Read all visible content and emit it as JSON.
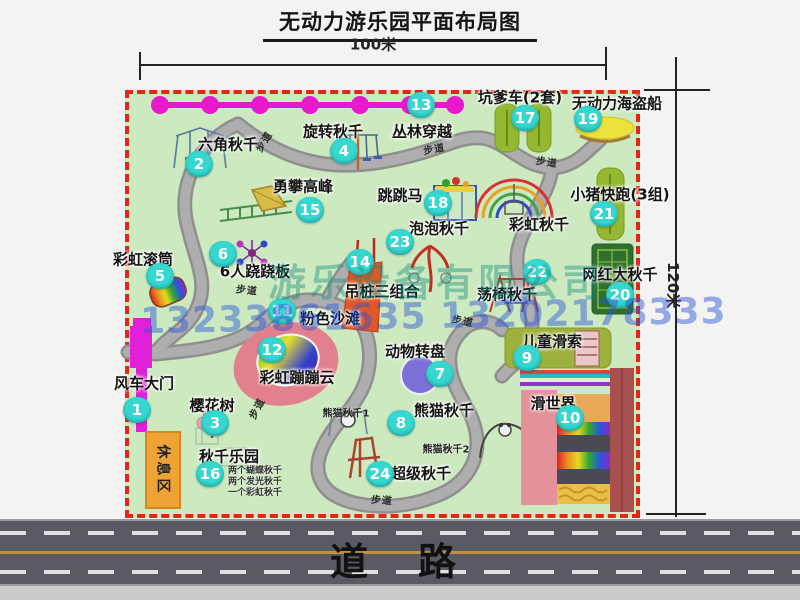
{
  "title": "无动力游乐园平面布局图",
  "dims": {
    "top": "100米",
    "right": "120米"
  },
  "road": {
    "label": "道路"
  },
  "watermark": {
    "company": "游乐设备有限公司",
    "phone": "13233861635 13202178333"
  },
  "rest_area_label": "休息区",
  "path_label": "步道",
  "rainbow_swing_label": "彩虹秋千",
  "panda_swing_sub": [
    "熊猫秋千1",
    "熊猫秋千2"
  ],
  "swing_park_details": [
    "两个蝴蝶秋千",
    "两个发光秋千",
    "一个彩虹秋千"
  ],
  "attractions": [
    {
      "num": "1",
      "label": "风车大门"
    },
    {
      "num": "2",
      "label": "六角秋千"
    },
    {
      "num": "3",
      "label": "樱花树"
    },
    {
      "num": "4",
      "label": "旋转秋千"
    },
    {
      "num": "5",
      "label": "彩虹滚筒"
    },
    {
      "num": "6",
      "label": "6人跷跷板"
    },
    {
      "num": "7",
      "label": "动物转盘"
    },
    {
      "num": "8",
      "label": "熊猫秋千"
    },
    {
      "num": "9",
      "label": "儿童滑索"
    },
    {
      "num": "10",
      "label": "滑世界"
    },
    {
      "num": "11",
      "label": "粉色沙滩"
    },
    {
      "num": "12",
      "label": "彩虹蹦蹦云"
    },
    {
      "num": "13",
      "label": "丛林穿越"
    },
    {
      "num": "14",
      "label": "吊桩三组合"
    },
    {
      "num": "15",
      "label": "勇攀高峰"
    },
    {
      "num": "16",
      "label": "秋千乐园"
    },
    {
      "num": "17",
      "label": "坑爹车(2套)"
    },
    {
      "num": "18",
      "label": "跳跳马"
    },
    {
      "num": "19",
      "label": "无动力海盗船"
    },
    {
      "num": "20",
      "label": "网红大秋千"
    },
    {
      "num": "21",
      "label": "小猪快跑(3组)"
    },
    {
      "num": "22",
      "label": "荡椅秋千"
    },
    {
      "num": "23",
      "label": "泡泡秋千"
    },
    {
      "num": "24",
      "label": "超级秋千"
    }
  ],
  "colors": {
    "park_green": "#cde9c0",
    "border_red": "#e02818",
    "bubble_teal": "#35d7cf",
    "gate_magenta": "#e020d8",
    "zipline_magenta": "#e818cc",
    "road_gray": "#5a5a62",
    "rest_orange": "#f0a335",
    "watermark_teal": "#108c7d",
    "watermark_blue": "#2855d7"
  }
}
